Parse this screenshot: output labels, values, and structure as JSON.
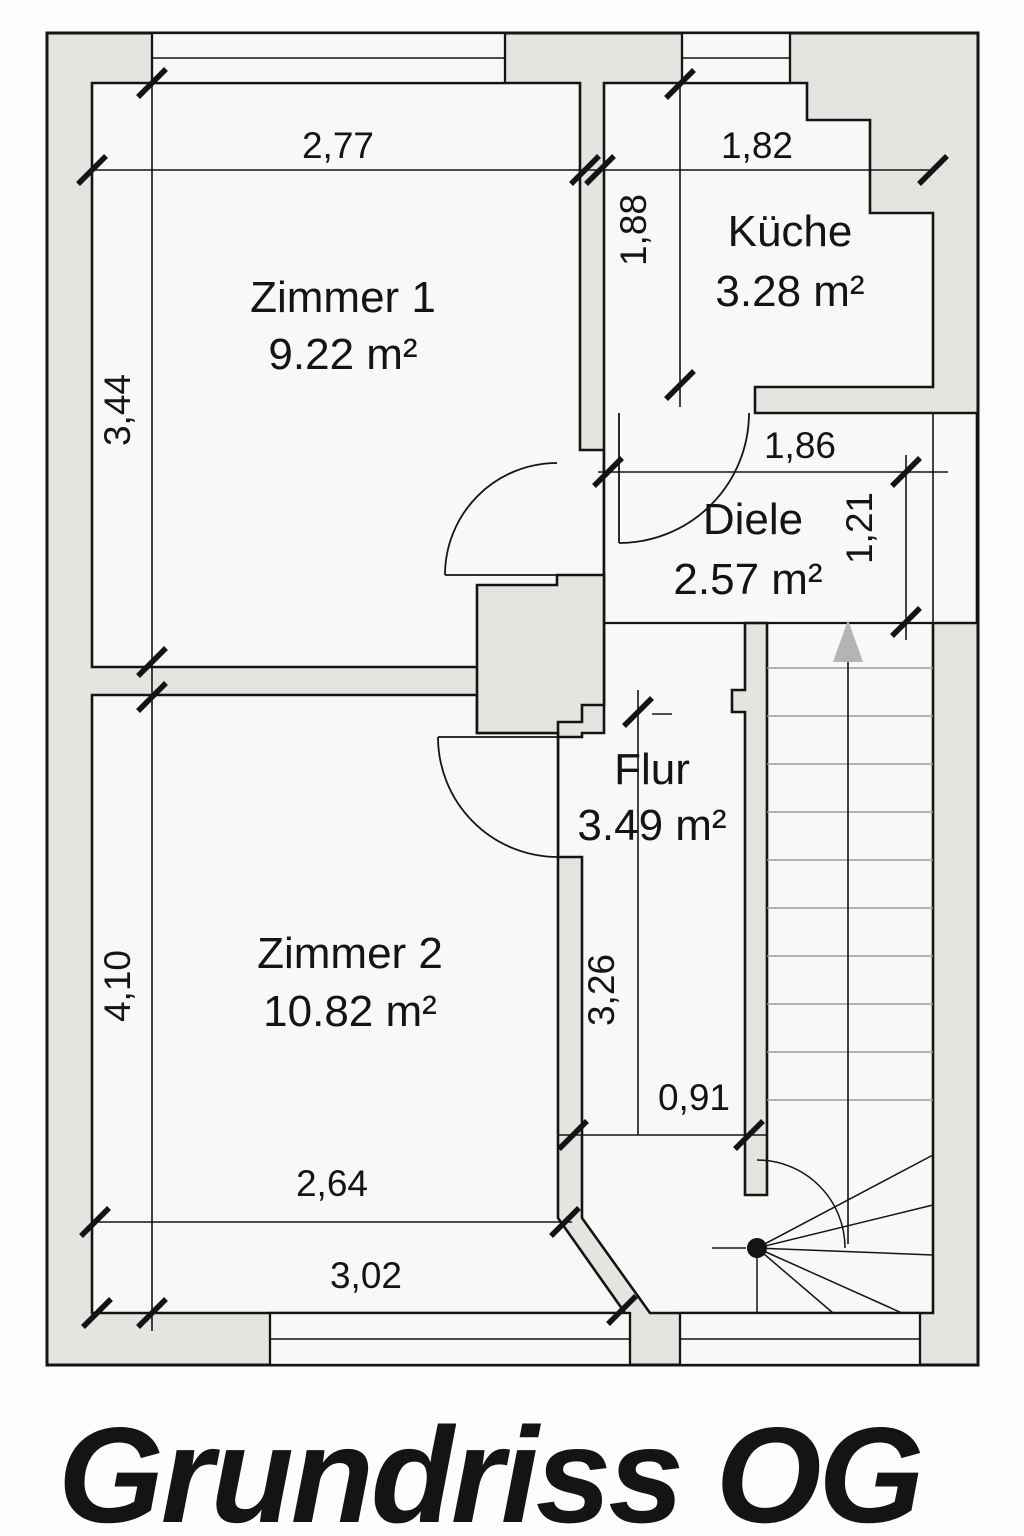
{
  "title": "Grundriss OG",
  "rooms": {
    "zimmer1": {
      "name": "Zimmer 1",
      "area": "9.22 m²"
    },
    "kueche": {
      "name": "Küche",
      "area": "3.28 m²"
    },
    "diele": {
      "name": "Diele",
      "area": "2.57 m²"
    },
    "flur": {
      "name": "Flur",
      "area": "3.49 m²"
    },
    "zimmer2": {
      "name": "Zimmer 2",
      "area": "10.82 m²"
    }
  },
  "dimensions": {
    "zimmer1_width": "2,77",
    "kueche_width": "1,82",
    "kueche_depth": "1,88",
    "zimmer1_depth": "3,44",
    "diele_width": "1,86",
    "diele_depth": "1,21",
    "zimmer2_depth": "4,10",
    "flur_depth": "3,26",
    "flur_width": "0,91",
    "zimmer2_width": "2,64",
    "bottom_width": "3,02"
  },
  "colors": {
    "wall_fill": "#e4e4e1",
    "floor_fill": "#f8f8f6",
    "line": "#141414",
    "stair_tread": "#9a9a9a",
    "arrow": "#b4b4b4",
    "background": "#fdfdfc"
  }
}
